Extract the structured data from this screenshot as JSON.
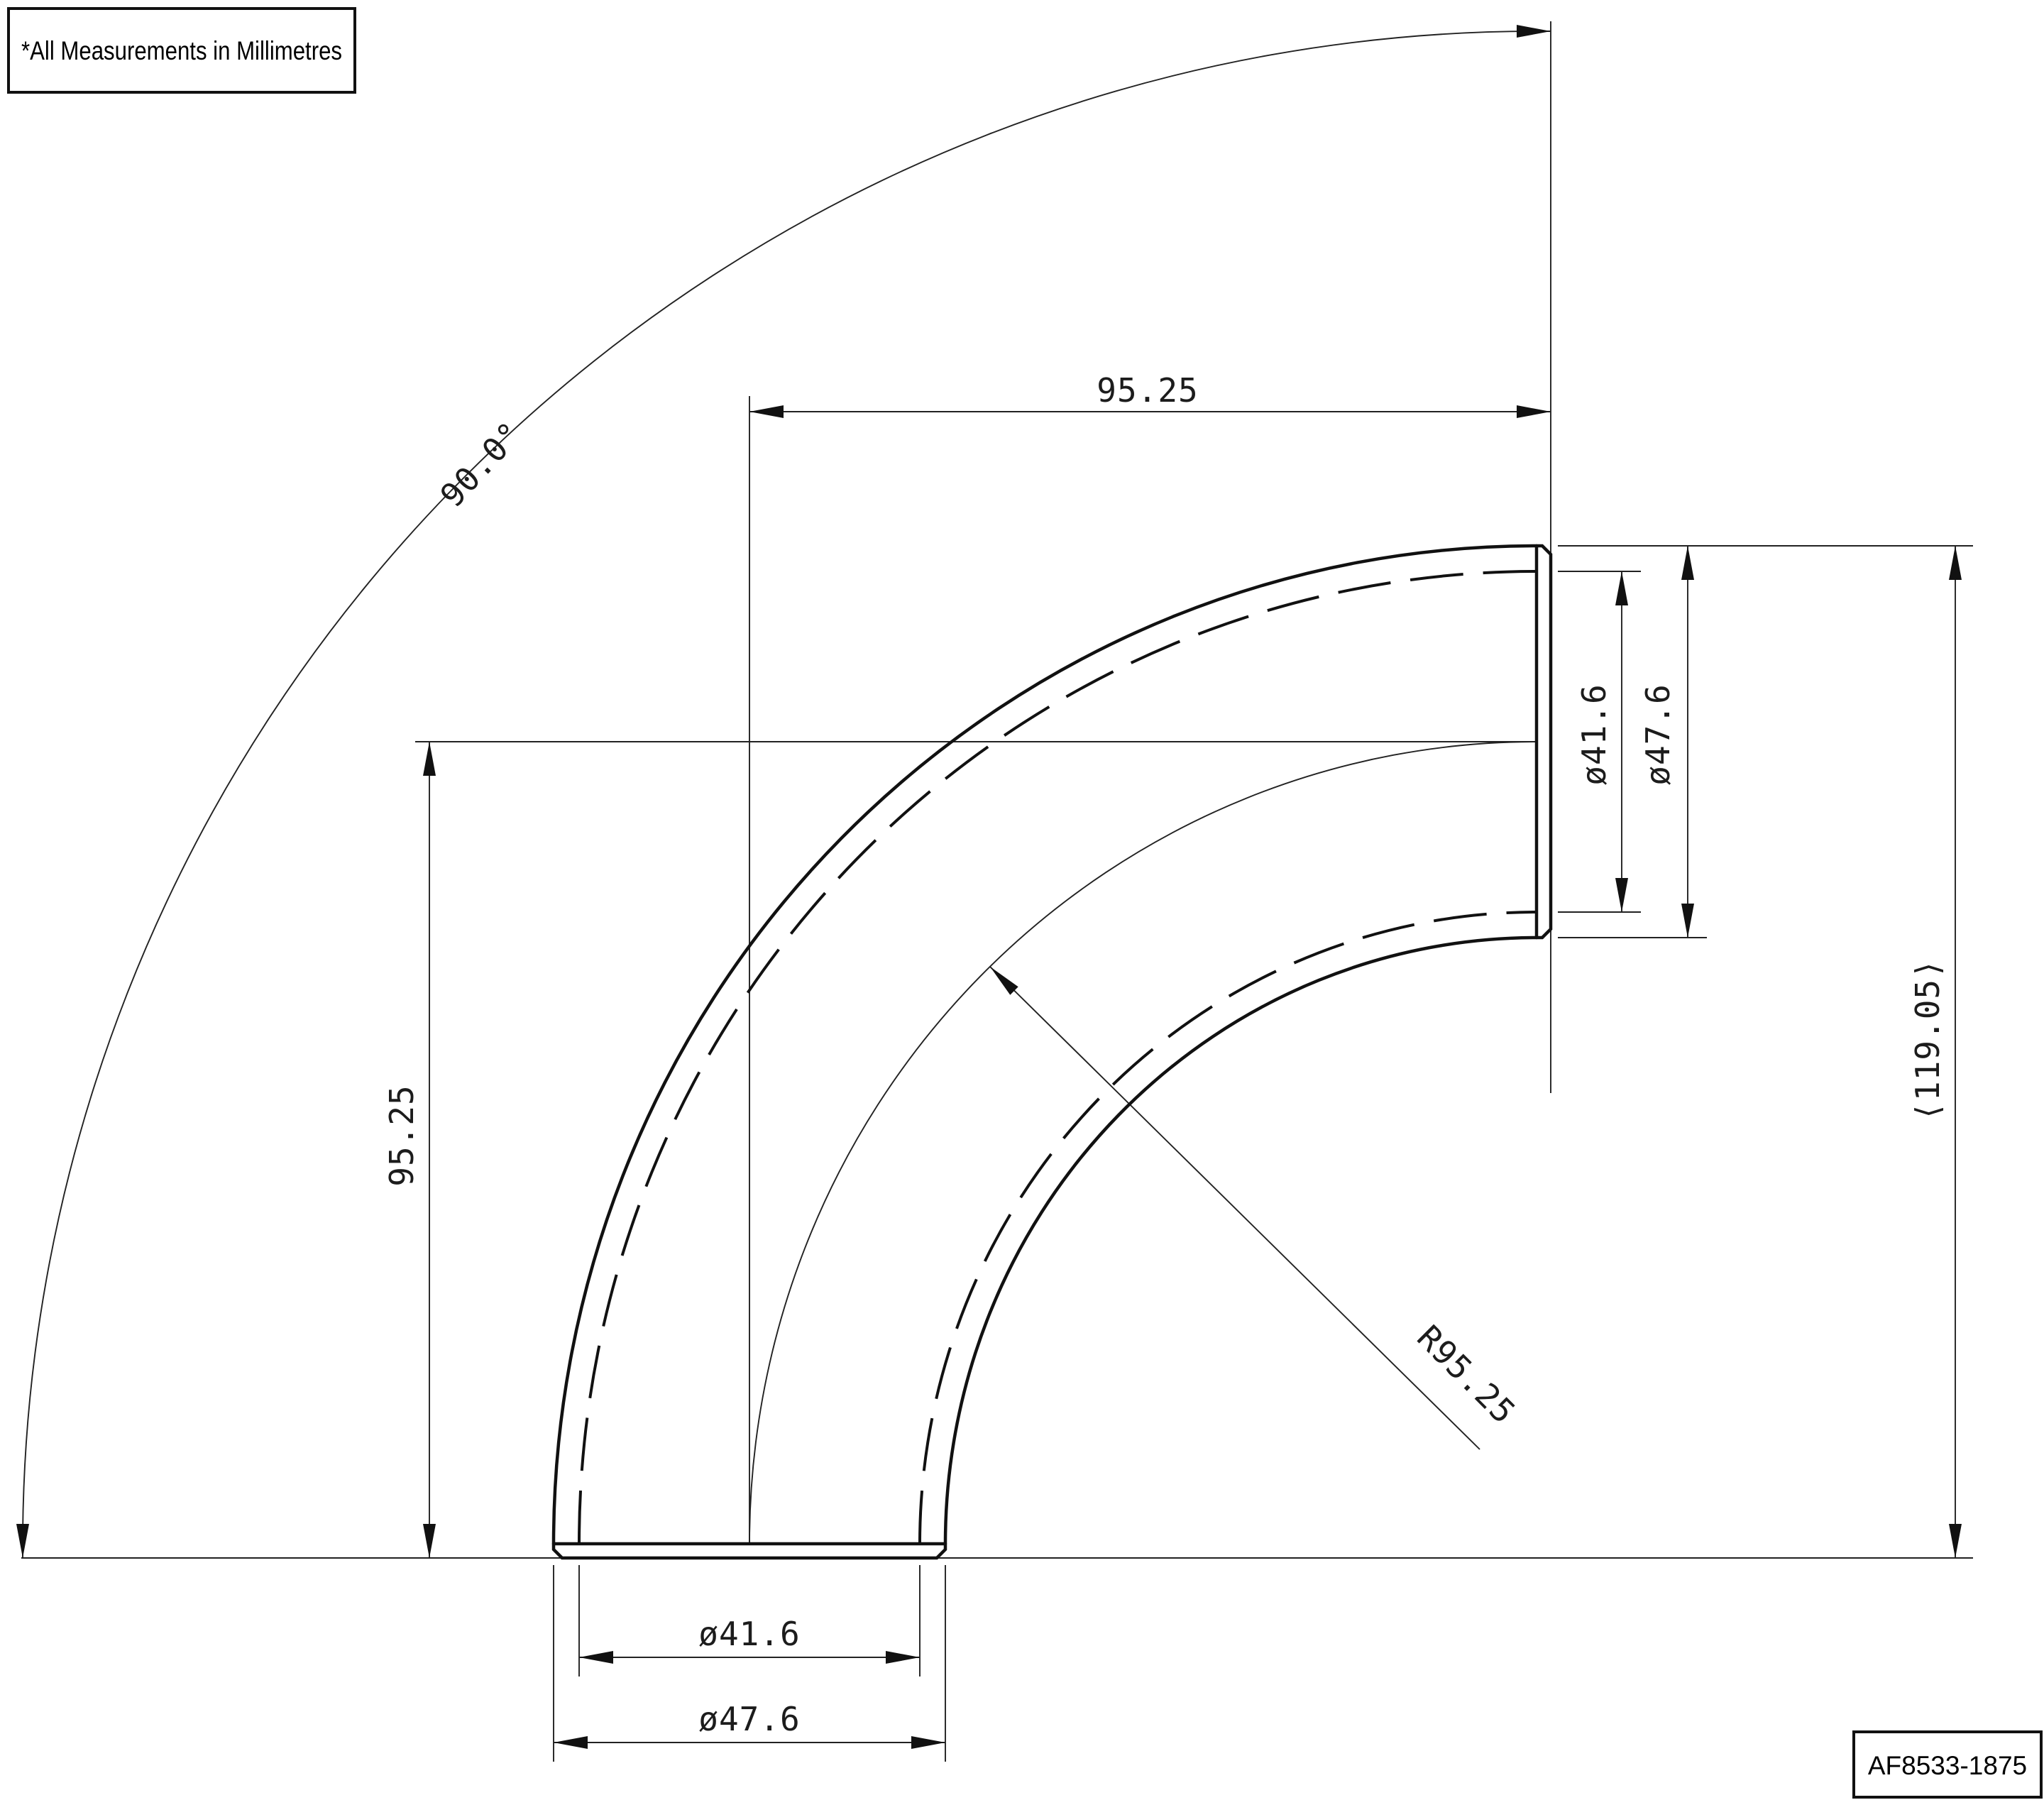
{
  "note": {
    "text": "*All Measurements in Millimetres"
  },
  "title_block": {
    "part_number": "AF8533-1875"
  },
  "units": "millimetres",
  "drawing": {
    "type": "90-degree pipe elbow, side elevation",
    "line_color": "#111111",
    "background": "#ffffff"
  },
  "dimensions": {
    "angle": "90.0°",
    "top_center_to_face": "95.25",
    "left_center_to_face": "95.25",
    "bend_radius": "R95.25",
    "outlet_inner_diameter": "ø41.6",
    "outlet_outer_diameter": "ø47.6",
    "overall_reference": "⟨119.05⟩",
    "inlet_inner_diameter": "ø41.6",
    "inlet_outer_diameter": "ø47.6"
  }
}
